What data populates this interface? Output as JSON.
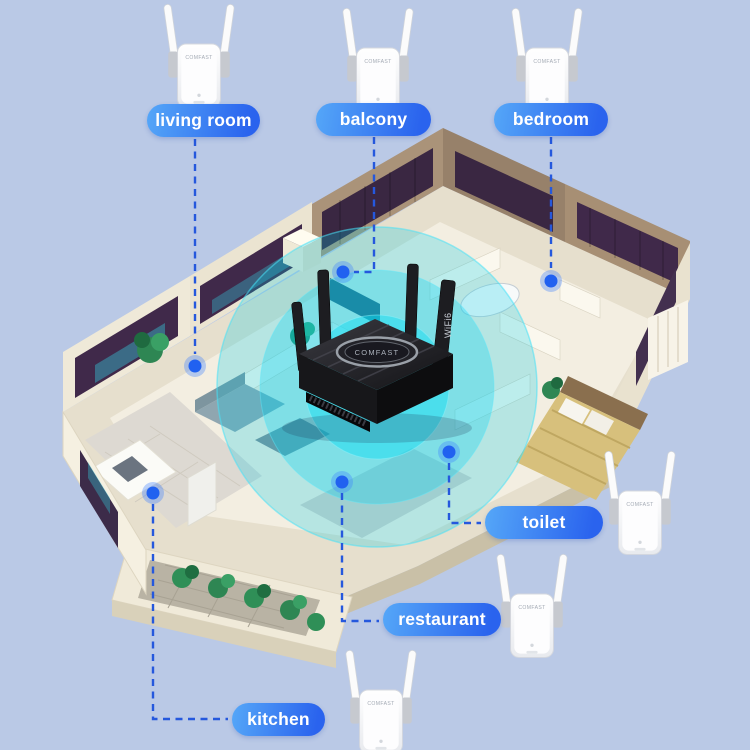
{
  "scene": {
    "background_color": "#bac9e6",
    "accent_color": "#2161f0",
    "leader_line_color": "#2558dd",
    "signal_color": "#00cde8",
    "label_gradient": [
      "#55a7f8",
      "#2a63ee"
    ]
  },
  "brand": "COMFAST",
  "router": {
    "badge": "WiFi6"
  },
  "rooms": {
    "living_room": {
      "label": "living room"
    },
    "balcony": {
      "label": "balcony"
    },
    "bedroom": {
      "label": "bedroom"
    },
    "toilet": {
      "label": "toilet"
    },
    "restaurant": {
      "label": "restaurant"
    },
    "kitchen": {
      "label": "kitchen"
    }
  },
  "icons": {
    "wifi_coverage_rings": "concentric-circles",
    "signal_dot": "filled-circle",
    "extender_device": "dual-antenna-repeater",
    "router_device": "four-antenna-router"
  }
}
